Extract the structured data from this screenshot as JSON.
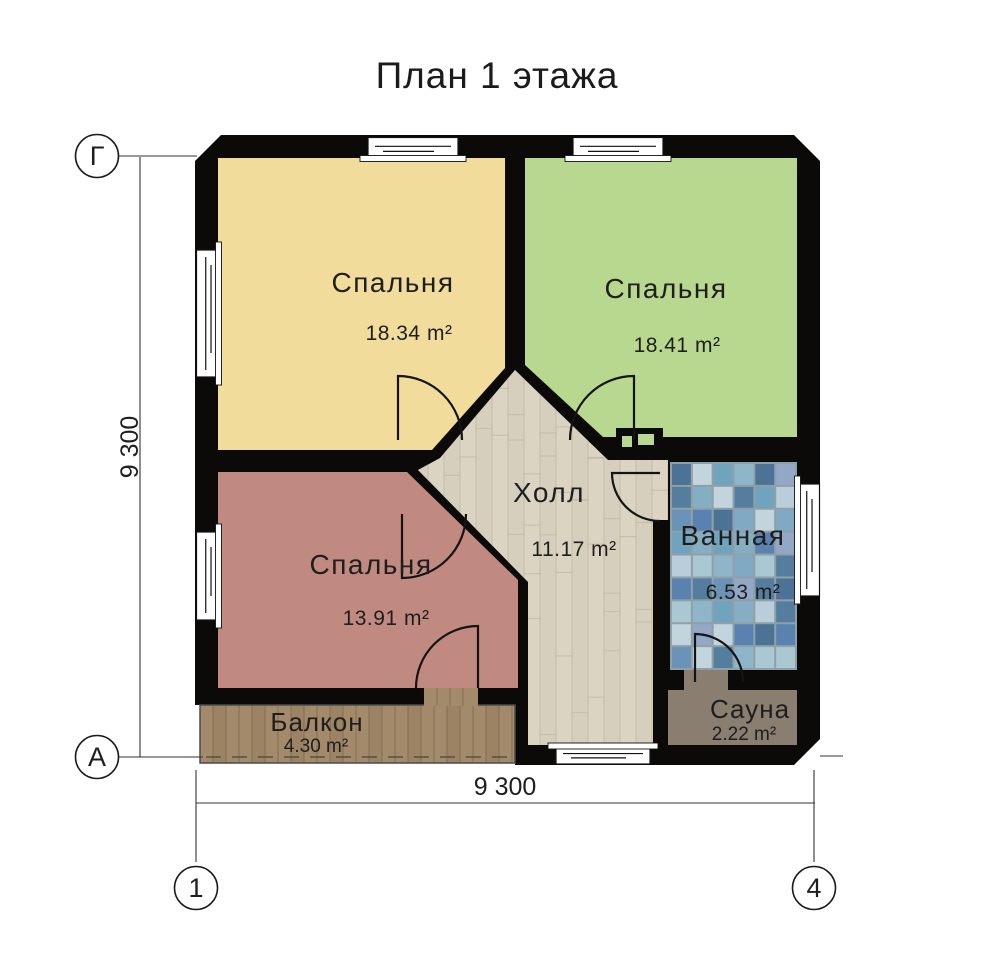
{
  "title": "План 1 этажа",
  "rooms": {
    "bedroom1": {
      "name": "Спальня",
      "area": "18.34 m²"
    },
    "bedroom2": {
      "name": "Спальня",
      "area": "18.41 m²"
    },
    "bedroom3": {
      "name": "Спальня",
      "area": "13.91 m²"
    },
    "hall": {
      "name": "Холл",
      "area": "11.17 m²"
    },
    "bathroom": {
      "name": "Ванная",
      "area": "6.53 m²"
    },
    "sauna": {
      "name": "Сауна",
      "area": "2.22 m²"
    },
    "balcony": {
      "name": "Балкон",
      "area": "4.30 m²"
    }
  },
  "axes": {
    "row_top": "Г",
    "row_bottom": "А",
    "col_left": "1",
    "col_right": "4"
  },
  "dimensions": {
    "left": "9 300",
    "bottom": "9 300"
  },
  "colors": {
    "wall": "#0b0a08",
    "bedroom1": "#F1DC9B",
    "bedroom2": "#B7D88E",
    "bedroom3": "#C08A81",
    "hall_floor": "#DCD4C3",
    "hall_plank_line": "#C6BBA4",
    "hall_plank_alt": "#D4CBB8",
    "balcony_wood": "#A28A6B",
    "balcony_plank_line": "#7D6A4E",
    "balcony_plank_alt": "#93795A",
    "sauna": "#8A7E70",
    "grout": "#8FA0A8",
    "tiles": [
      "#5A82B0",
      "#8FB6C8",
      "#C2D4DC",
      "#4C7396",
      "#7FA9C4",
      "#A9C8D2",
      "#6B93B8",
      "#B9CEDA",
      "#6FA3BE",
      "#93A8C6",
      "#557E9E",
      "#86AEC2"
    ]
  }
}
